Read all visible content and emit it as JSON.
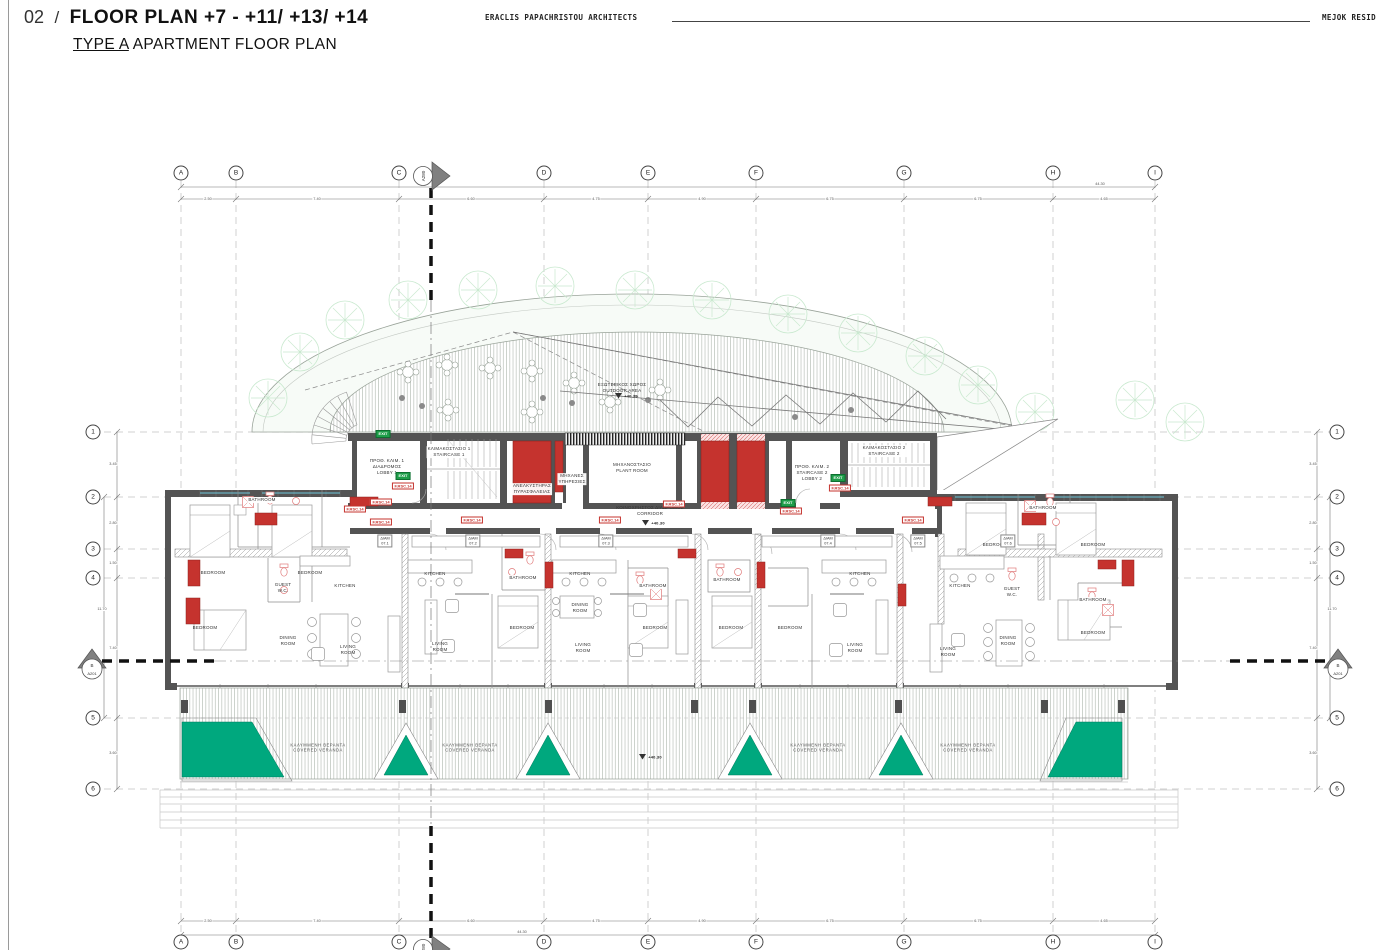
{
  "header": {
    "number": "02",
    "separator": "/",
    "title": "FLOOR PLAN +7 - +11/ +13/ +14",
    "subtitle_type": "TYPE A",
    "subtitle_rest": " APARTMENT FLOOR PLAN",
    "architect": "ERACLIS PAPACHRISTOU ARCHITECTS",
    "project": "MEJOK RESID"
  },
  "grid": {
    "columns": [
      "A",
      "B",
      "C",
      "D",
      "E",
      "F",
      "G",
      "H",
      "I"
    ],
    "rows": [
      "1",
      "2",
      "3",
      "4",
      "5",
      "6"
    ],
    "top_dims": [
      "2.50",
      "7.40",
      "6.60",
      "4.75",
      "4.90",
      "6.75",
      "6.75",
      "4.65"
    ],
    "overall_width": "44.30",
    "side_dims": [
      "3.45",
      "2.80",
      "1.50",
      "7.40",
      "3.60"
    ],
    "side_overall": "11.70"
  },
  "section_markers": {
    "cut_vertical": "A280",
    "cut_horizontal_ref": "B",
    "cut_horizontal_sheet": "A201"
  },
  "plan": {
    "core": {
      "staircase1": "ΚΛΙΜΑΚΟΣΤΑΣΙΟ 1\nSTAIRCASE 1",
      "lobby1": "ΠΡΟΘ. ΚΛΙΜ. 1\nΔΙΑΔΡΟΜΟΣ\nLOBBY 1",
      "plant_room": "ΜΗΧΑΝΟΣΤΑΣΙΟ\nPLANT ROOM",
      "fire_lift": "ΑΝΕΛΚΥΣΤΗΡΑΣ\nΠΥΡΑΣΦΑΛΕΙΑΣ",
      "services": "ΜΗΧΑΝΕΣ\nΥΠΗΡΕΣΙΕΣ",
      "lobby2": "ΠΡΟΘ. ΚΛΙΜ. 2\nSTAIRCASE 2\nLOBBY 2",
      "staircase2": "ΚΛΙΜΑΚΟΣΤΑΣΙΟ 2\nSTAIRCASE 2",
      "corridor": "ΚΟΙΝΟΧΡΗΣΤΟΣ ΔΙΑΔΡΟΜΟΣ\nCORRIDOR",
      "outdoor": "ΕΞΩΤΕΡΙΚΟΣ ΧΩΡΟΣ\nOUTDOOR AREA"
    },
    "rooms": {
      "bedroom": "BEDROOM",
      "bathroom": "BATHROOM",
      "kitchen": "KITCHEN",
      "dining": "DINING\nROOM",
      "living": "LIVING\nROOM",
      "guest_wc": "GUEST\nW.C."
    },
    "veranda": "ΚΑΛΥΜΜΕΝΗ ΒΕΡΑΝΤΑ\nCOVERED VERANDA",
    "levels": {
      "floor": "+40.30"
    },
    "tags": {
      "exit": "EXIT",
      "fire_rating": "F.RSC.14",
      "apt_prefix": "ΔΙΑΜ",
      "apartments": [
        "07.1",
        "07.2",
        "07.3",
        "07.4",
        "07.5",
        "07.6"
      ]
    }
  },
  "colors": {
    "planter_green": "#00a87e",
    "shaft_red": "#c5332e",
    "window_cyan": "#6cc5d8",
    "exit_green": "#1e9e4a",
    "wall_gray": "#545454"
  }
}
